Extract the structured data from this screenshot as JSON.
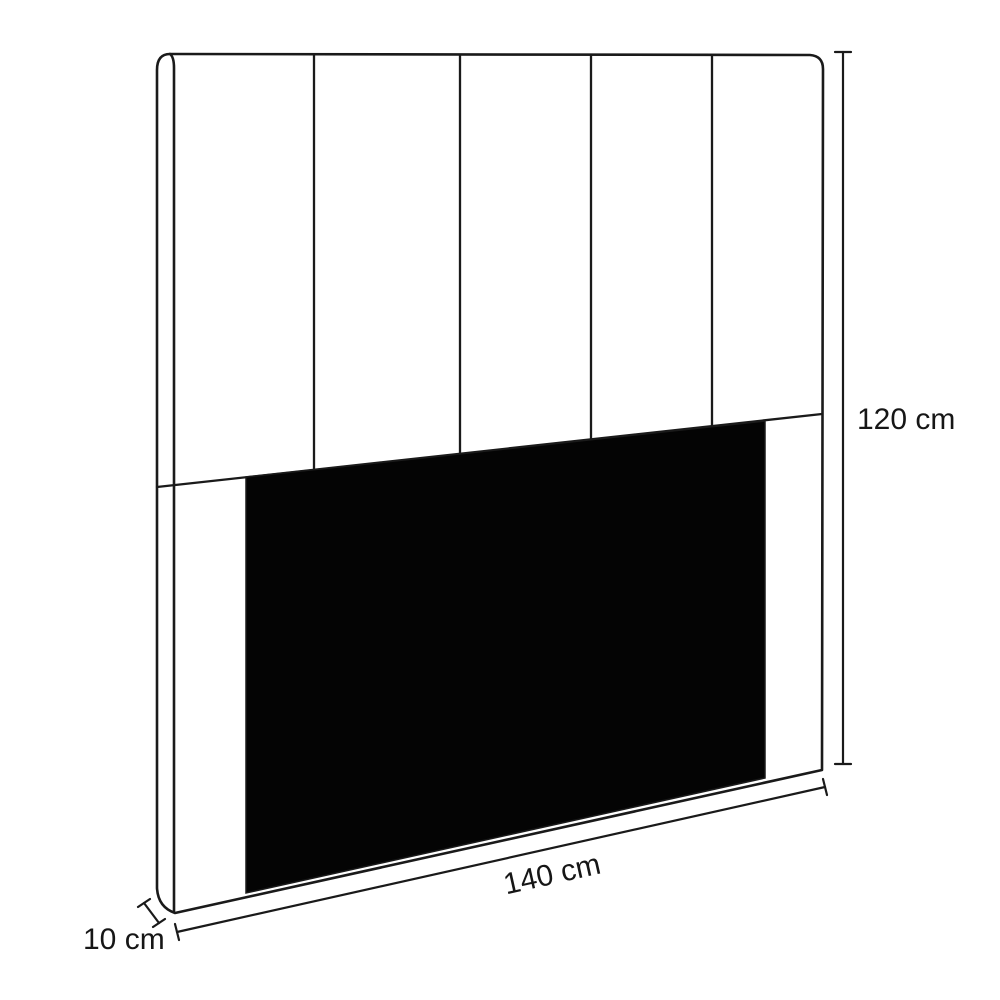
{
  "diagram": {
    "type": "furniture-dimension-diagram",
    "subject": "upholstered headboard with vertical panels",
    "panel_count": 5,
    "dimensions": {
      "height_label": "120 cm",
      "width_label": "140 cm",
      "depth_label": "10 cm"
    },
    "colors": {
      "line": "#1a1a1a",
      "panel_fill": "#040404",
      "background": "#ffffff"
    }
  }
}
